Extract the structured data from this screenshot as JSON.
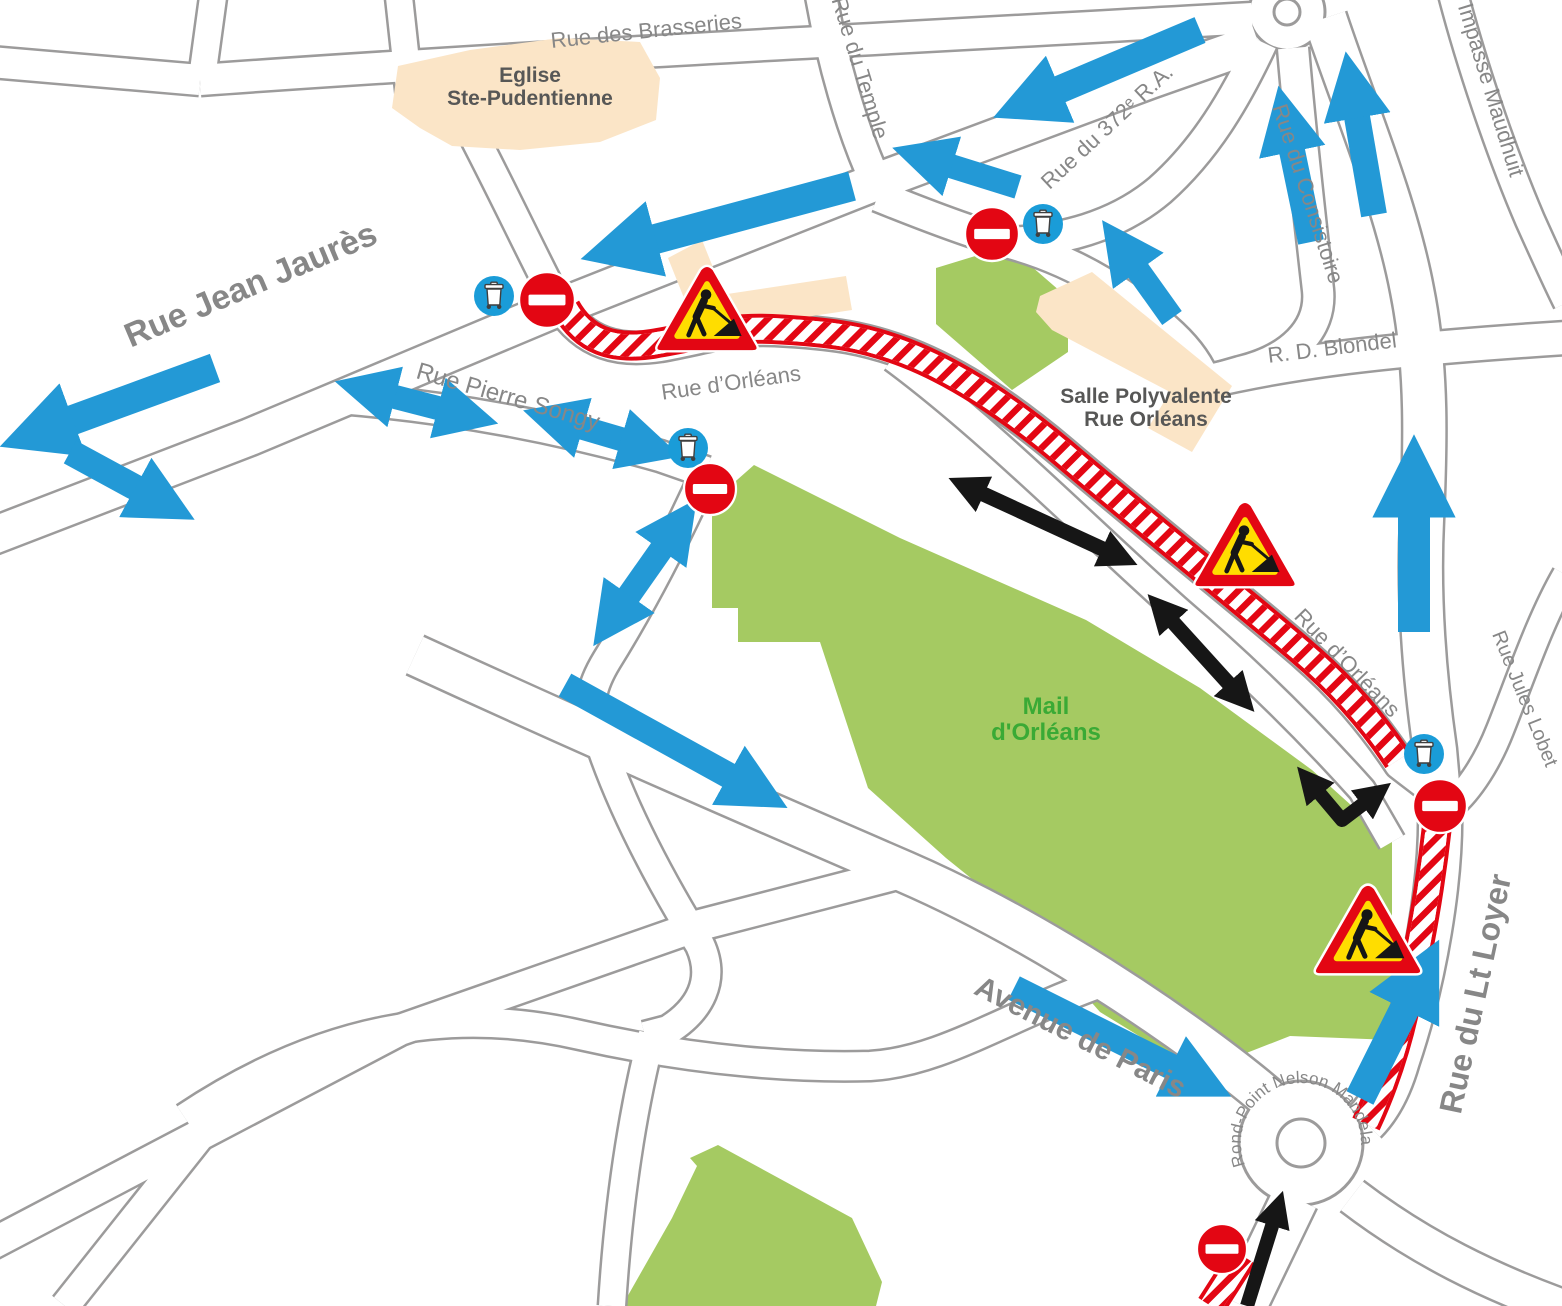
{
  "map": {
    "colors": {
      "street_casing": "#9c9b9b",
      "street_fill": "#ffffff",
      "park_green": "#a5ca62",
      "building_beige": "#fbe5c7",
      "deviation_blue": "#2399d6",
      "bin_circle_blue": "#1a9cd8",
      "closure_red": "#e30613",
      "works_yellow": "#ffdd00",
      "arrow_black": "#161616",
      "street_label_gray": "#878787",
      "place_label_gray": "#575756",
      "park_label_green": "#3aaa35"
    },
    "parks": [
      {
        "name": "mail-dorleans-park",
        "d": "M712,502 L754,465 L900,538 L1086,620 L1200,688 L1312,770 L1392,842 L1392,1040 L1290,1036 L1198,1072 L1100,1012 L1008,908 L946,858 L868,788 L820,642 L738,642 L738,608 L712,608 Z"
      },
      {
        "name": "park-northeast-piece",
        "d": "M936,268 L1008,246 L1068,298 L1068,352 L1012,390 L936,324 Z"
      },
      {
        "name": "park-south-piece",
        "d": "M718,1145 L852,1218 L882,1282 L876,1306 L622,1306 L672,1218 L697,1166 L690,1158 Z"
      }
    ],
    "buildings": [
      {
        "name": "eglise-ste-pudentienne-building",
        "d": "M392,108 L398,66 L470,50 L560,38 L640,42 L660,78 L656,120 L600,142 L520,150 L452,146 L420,128 Z"
      },
      {
        "name": "building-north-of-orleans-small",
        "d": "M668,258 L702,240 L722,290 L688,308 Z"
      },
      {
        "name": "building-north-of-orleans-long",
        "d": "M714,296 L846,276 L852,310 L720,330 Z"
      },
      {
        "name": "salle-polyvalente-building",
        "d": "M1040,296 L1092,272 L1232,386 L1192,452 L1148,428 L1170,392 L1052,330 L1036,312 Z"
      }
    ],
    "streets": [
      {
        "name": "rue-jean-jaures",
        "d": "M-10,537 L250,437 L560,307 L876,182 L1150,80 L1258,42",
        "w": 36
      },
      {
        "name": "rue-des-brasseries",
        "d": "M200,80 C500,58 900,38 1252,18",
        "w": 30
      },
      {
        "name": "top-left-street",
        "d": "M-10,62 L200,80",
        "w": 30
      },
      {
        "name": "top-left-stub",
        "d": "M214,-10 L202,78",
        "w": 26
      },
      {
        "name": "temple-north-stub",
        "d": "M398,-12 L410,98",
        "w": 26
      },
      {
        "name": "church-west-street",
        "d": "M458,106 C495,175 525,240 556,300",
        "w": 28
      },
      {
        "name": "rue-du-temple",
        "d": "M820,-10 C832,60 852,130 876,182",
        "w": 30
      },
      {
        "name": "rue-du-372-ra",
        "d": "M1262,42 C1235,100 1205,150 1160,190 C1115,228 1060,240 1010,243",
        "w": 30
      },
      {
        "name": "park-north-street",
        "d": "M878,196 C950,225 990,238 1010,243 C1080,262 1135,300 1172,335 C1190,352 1200,368 1205,382",
        "w": 30
      },
      {
        "name": "rue-du-consistoire",
        "d": "M1293,48 C1300,130 1310,220 1318,290 C1322,330 1290,360 1240,372 L1205,382",
        "w": 30
      },
      {
        "name": "rue-blondel",
        "d": "M1205,382 C1290,362 1380,350 1566,338",
        "w": 32
      },
      {
        "name": "impasse-maudhuit",
        "d": "M1452,-10 C1470,60 1500,150 1530,220 C1548,260 1562,290 1568,302",
        "w": 28
      },
      {
        "name": "rue-du-lt-loyer",
        "d": "M1325,18 C1352,100 1395,200 1412,290 C1428,370 1425,450 1422,520 C1418,600 1425,680 1435,750 L1440,806 C1442,880 1425,980 1398,1060 C1388,1095 1375,1112 1365,1122",
        "w": 42
      },
      {
        "name": "rue-jules-lobet",
        "d": "M1566,575 C1540,620 1520,680 1500,730 C1485,768 1465,795 1448,808",
        "w": 26
      },
      {
        "name": "rue-dorleans-closed",
        "d": "M560,305 C585,345 620,352 660,346 C710,337 730,328 775,330 C835,333 865,338 908,354 C962,375 1012,410 1062,452 C1132,512 1232,592 1302,652 C1342,687 1372,722 1400,764 L1434,790",
        "w": 30
      },
      {
        "name": "mall-service-road",
        "d": "M893,358 C990,430 1090,532 1180,612 C1250,672 1310,732 1362,790 L1392,842",
        "w": 26
      },
      {
        "name": "rue-pierre-songy",
        "d": "M340,398 C460,408 560,428 660,456 L706,472",
        "w": 30
      },
      {
        "name": "connector-street",
        "d": "M706,472 C668,555 635,615 607,660 C590,688 588,705 596,730 C618,800 655,872 700,945 C716,980 700,1010 668,1030 L645,1036",
        "w": 28
      },
      {
        "name": "connector-south",
        "d": "M652,1034 C630,1120 618,1210 612,1306",
        "w": 26
      },
      {
        "name": "avenue-de-paris",
        "d": "M415,655 C600,740 750,805 905,872 C1050,935 1200,1040 1268,1098",
        "w": 40
      },
      {
        "name": "southwest-diagonal",
        "d": "M-10,1245 L400,1030 L700,925 L905,872",
        "w": 30
      },
      {
        "name": "southwest-stub",
        "d": "M65,1306 L235,1092",
        "w": 28
      },
      {
        "name": "s-curve-street",
        "d": "M185,1118 C320,1028 450,1005 580,1035 C700,1062 800,1068 870,1066 C940,1062 1000,1020 1095,985",
        "w": 28
      },
      {
        "name": "roundabout-south-exit",
        "d": "M1295,1198 L1243,1306",
        "w": 46
      },
      {
        "name": "roundabout-southeast-exit",
        "d": "M1352,1196 C1420,1248 1490,1282 1568,1310",
        "w": 36
      }
    ],
    "roundabouts": [
      {
        "name": "rond-point-nelson-mandela",
        "cx": 1301,
        "cy": 1143,
        "r_outer": 62,
        "r_island": 24
      },
      {
        "name": "top-roundabout",
        "cx": 1287,
        "cy": 12,
        "r_outer": 38,
        "r_island": 13
      }
    ],
    "closed_sections": [
      {
        "name": "closed-rue-dorleans",
        "d": "M566,308 C584,340 612,350 652,344 C700,336 726,327 772,329 C834,332 864,337 906,353 C960,374 1012,410 1062,452 C1132,512 1232,592 1300,650 C1340,684 1372,720 1398,760"
      },
      {
        "name": "closed-lt-loyer-upper",
        "d": "M1437,826 C1431,880 1420,950 1404,1012 C1394,1056 1380,1094 1366,1124"
      },
      {
        "name": "closed-below-roundabout",
        "d": "M1243,1256 L1211,1306"
      }
    ],
    "deviation_arrows": [
      {
        "name": "arrow-west-exit",
        "pts": [
          [
            215,
            368
          ],
          [
            40,
            432
          ]
        ],
        "w": 30,
        "double": false
      },
      {
        "name": "arrow-southeast-branch",
        "pts": [
          [
            70,
            452
          ],
          [
            162,
            502
          ]
        ],
        "w": 26,
        "double": false
      },
      {
        "name": "arrow-along-jaures-west",
        "pts": [
          [
            852,
            186
          ],
          [
            622,
            248
          ]
        ],
        "w": 30,
        "double": false
      },
      {
        "name": "arrow-north-long-west",
        "pts": [
          [
            1200,
            30
          ],
          [
            1030,
            102
          ]
        ],
        "w": 28,
        "double": false
      },
      {
        "name": "arrow-north-short-west",
        "pts": [
          [
            1018,
            187
          ],
          [
            925,
            158
          ]
        ],
        "w": 24,
        "double": false
      },
      {
        "name": "arrow-consistoire-up",
        "pts": [
          [
            1311,
            242
          ],
          [
            1286,
            122
          ]
        ],
        "w": 26,
        "double": false
      },
      {
        "name": "arrow-blondel-connector-up",
        "pts": [
          [
            1172,
            318
          ],
          [
            1122,
            248
          ]
        ],
        "w": 24,
        "double": false
      },
      {
        "name": "arrow-topright-up",
        "pts": [
          [
            1374,
            215
          ],
          [
            1352,
            88
          ]
        ],
        "w": 26,
        "double": false
      },
      {
        "name": "arrow-ltloyer-north-up",
        "pts": [
          [
            1414,
            632
          ],
          [
            1414,
            480
          ]
        ],
        "w": 32,
        "double": false
      },
      {
        "name": "arrow-pierre-songy-west",
        "pts": [
          [
            368,
            390
          ],
          [
            465,
            415
          ]
        ],
        "w": 24,
        "double": true
      },
      {
        "name": "arrow-pierre-songy-east",
        "pts": [
          [
            556,
            420
          ],
          [
            648,
            447
          ]
        ],
        "w": 24,
        "double": true
      },
      {
        "name": "arrow-connector-twoway",
        "pts": [
          [
            613,
            618
          ],
          [
            677,
            527
          ]
        ],
        "w": 24,
        "double": true
      },
      {
        "name": "arrow-avenue-paris-west",
        "pts": [
          [
            565,
            685
          ],
          [
            755,
            790
          ]
        ],
        "w": 26,
        "double": false
      },
      {
        "name": "arrow-avenue-paris-east",
        "pts": [
          [
            1014,
            988
          ],
          [
            1198,
            1080
          ]
        ],
        "w": 26,
        "double": false
      },
      {
        "name": "arrow-ltloyer-south-up",
        "pts": [
          [
            1360,
            1098
          ],
          [
            1420,
            978
          ]
        ],
        "w": 30,
        "double": false
      }
    ],
    "local_access_arrows": [
      {
        "name": "local-twoway-upper",
        "pts": [
          [
            968,
            487
          ],
          [
            1118,
            556
          ]
        ],
        "w": 15,
        "double": true
      },
      {
        "name": "local-twoway-lower",
        "pts": [
          [
            1162,
            610
          ],
          [
            1240,
            696
          ]
        ],
        "w": 15,
        "double": true
      },
      {
        "name": "local-twoway-bend",
        "pts": [
          [
            1310,
            782
          ],
          [
            1342,
            820
          ],
          [
            1375,
            795
          ]
        ],
        "w": 14,
        "double": true
      },
      {
        "name": "local-entry-south",
        "pts": [
          [
            1247,
            1306
          ],
          [
            1277,
            1210
          ]
        ],
        "w": 14,
        "double": false
      }
    ],
    "no_entry_signs": [
      {
        "x": 547,
        "y": 300,
        "r": 28
      },
      {
        "x": 992,
        "y": 234,
        "r": 27
      },
      {
        "x": 710,
        "y": 489,
        "r": 26
      },
      {
        "x": 1440,
        "y": 806,
        "r": 27
      },
      {
        "x": 1222,
        "y": 1249,
        "r": 25
      }
    ],
    "bin_collection_points": [
      {
        "x": 494,
        "y": 296,
        "r": 20
      },
      {
        "x": 1043,
        "y": 224,
        "r": 20
      },
      {
        "x": 688,
        "y": 448,
        "r": 20
      },
      {
        "x": 1424,
        "y": 754,
        "r": 20
      }
    ],
    "roadworks_signs": [
      {
        "x": 707,
        "y": 310,
        "s": 100
      },
      {
        "x": 1245,
        "y": 546,
        "s": 100
      },
      {
        "x": 1368,
        "y": 931,
        "s": 105
      }
    ],
    "street_labels": [
      {
        "text": "Rue Jean Jaurès",
        "x": 255,
        "y": 295,
        "rot": -23,
        "size": 34,
        "bold": true
      },
      {
        "text": "Rue des Brasseries",
        "x": 647,
        "y": 38,
        "rot": -6,
        "size": 22,
        "bold": false
      },
      {
        "text": "Rue du Temple",
        "x": 853,
        "y": 70,
        "rot": 73,
        "size": 22,
        "bold": false
      },
      {
        "text": "Rue du 372ᵉ R.A.",
        "x": 1112,
        "y": 132,
        "rot": -43,
        "size": 22,
        "bold": false
      },
      {
        "text": "Rue du Consistoire",
        "x": 1301,
        "y": 196,
        "rot": 72,
        "size": 22,
        "bold": false
      },
      {
        "text": "Impasse Maudhuit",
        "x": 1484,
        "y": 92,
        "rot": 73,
        "size": 22,
        "bold": false
      },
      {
        "text": "R. D. Blondel",
        "x": 1333,
        "y": 355,
        "rot": -7,
        "size": 22,
        "bold": false
      },
      {
        "text": "Rue d’Orléans",
        "x": 732,
        "y": 390,
        "rot": -8,
        "size": 22,
        "bold": false
      },
      {
        "text": "Rue Pierre Songy",
        "x": 506,
        "y": 404,
        "rot": 16,
        "size": 24,
        "bold": false
      },
      {
        "text": "Rue d’Orléans",
        "x": 1342,
        "y": 668,
        "rot": 46,
        "size": 22,
        "bold": false
      },
      {
        "text": "Rue Jules Lobet",
        "x": 1519,
        "y": 701,
        "rot": 68,
        "size": 20,
        "bold": false
      },
      {
        "text": "Rue du Lt Loyer",
        "x": 1486,
        "y": 996,
        "rot": -78,
        "size": 32,
        "bold": true
      },
      {
        "text": "Avenue de Paris",
        "x": 1076,
        "y": 1046,
        "rot": 27,
        "size": 30,
        "bold": true
      }
    ],
    "place_labels": [
      {
        "name": "eglise-ste-pudentienne-label",
        "lines": [
          "Eglise",
          "Ste-Pudentienne"
        ],
        "x": 530,
        "y": 82,
        "size": 21,
        "color_key": "place_label_gray"
      },
      {
        "name": "salle-polyvalente-label",
        "lines": [
          "Salle Polyvalente",
          "Rue Orléans"
        ],
        "x": 1146,
        "y": 403,
        "size": 21,
        "color_key": "place_label_gray"
      },
      {
        "name": "mail-dorleans-label",
        "lines": [
          "Mail",
          "d'Orléans"
        ],
        "x": 1046,
        "y": 714,
        "size": 24,
        "color_key": "park_label_green"
      }
    ],
    "curved_labels": [
      {
        "name": "rond-point-nelson-mandela-label",
        "text": "Rond-Point Nelson Mandela",
        "cx": 1301,
        "cy": 1143,
        "r": 60,
        "size": 17
      }
    ]
  }
}
